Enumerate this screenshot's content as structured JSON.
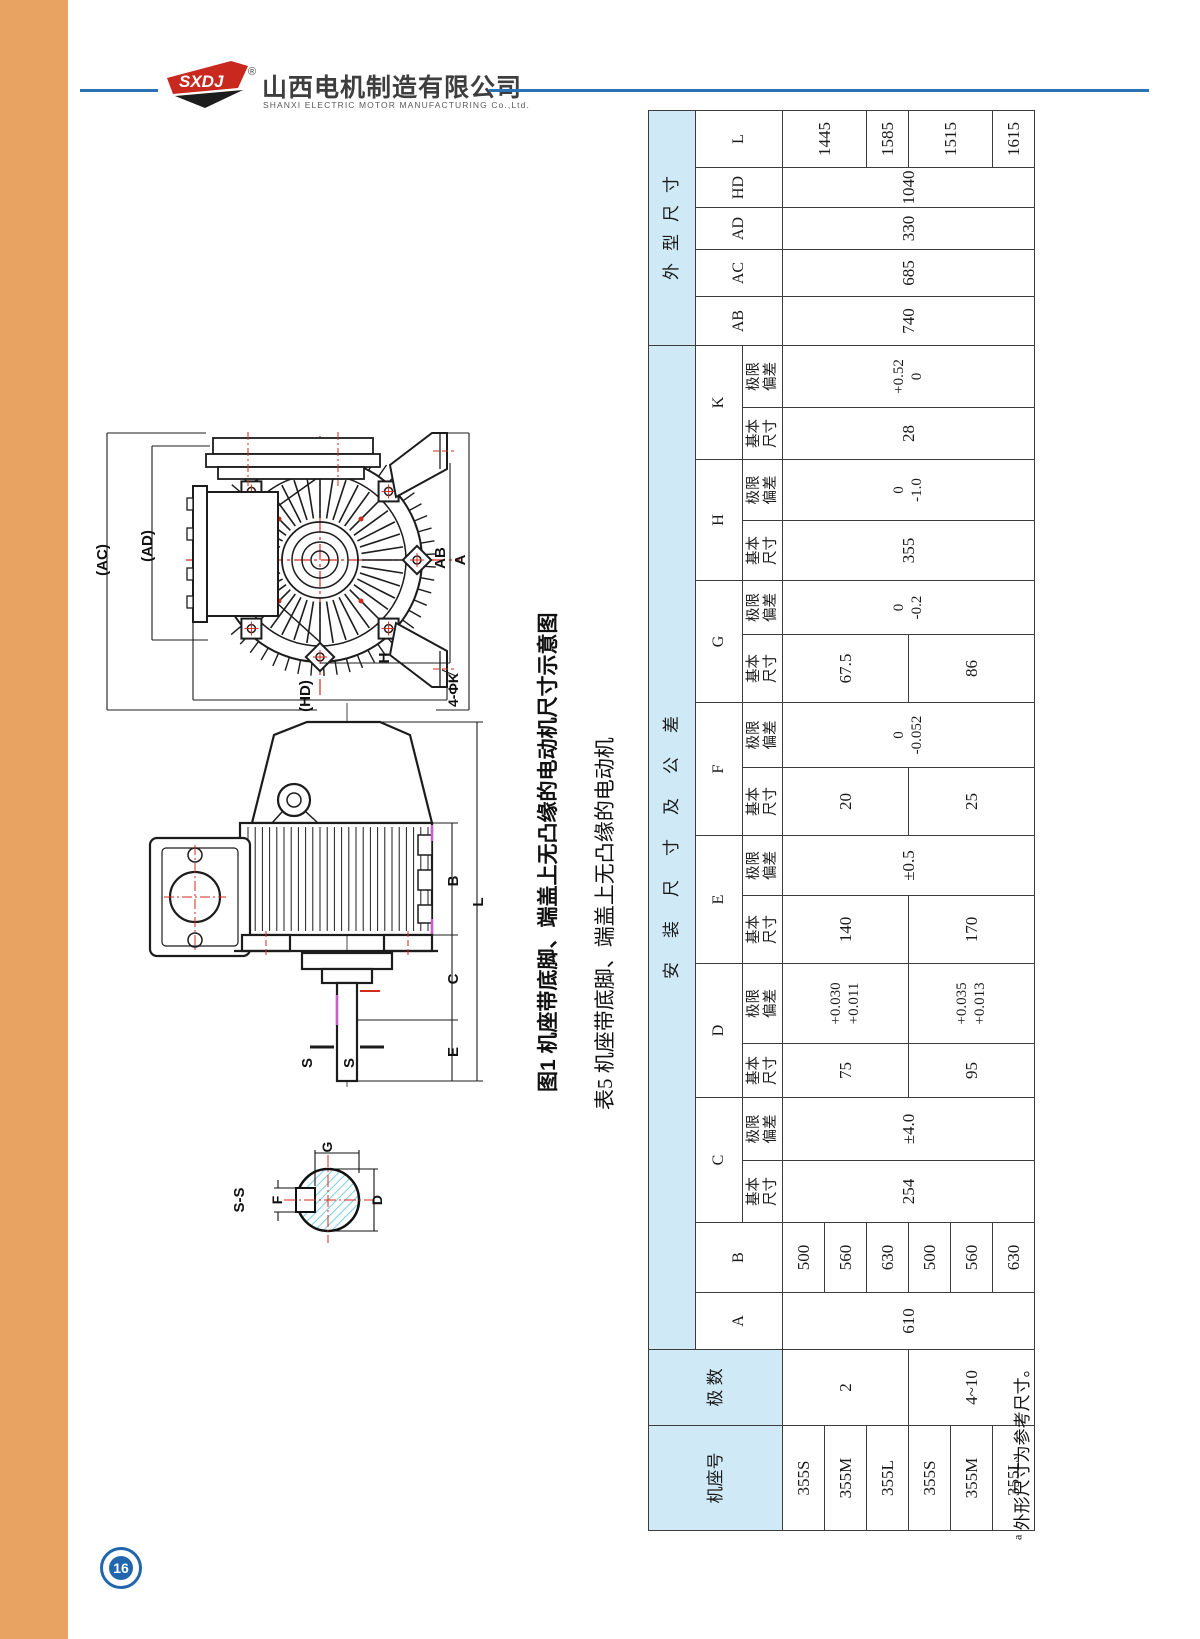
{
  "page": {
    "number": "16"
  },
  "brand": {
    "logo": "SXDJ",
    "registered": "®",
    "company_cn": "山西电机制造有限公司",
    "company_en": "SHANXI ELECTRIC MOTOR MANUFACTURING Co.,Ltd."
  },
  "colors": {
    "orange_bar": "#e8a262",
    "header_fill": "#cfe9f7",
    "rule_blue": "#2a72b5",
    "badge_blue": "#2166ac",
    "centerline_red": "#d42a1e",
    "hatch_cyan": "#7ccfe0"
  },
  "figure": {
    "caption": "图1 机座带底脚、端盖上无凸缘的电动机尺寸示意图",
    "labels": {
      "ac": "(AC)",
      "ad": "(AD)",
      "ab": "AB",
      "a": "A",
      "h": "H",
      "hd": "(HD)",
      "k": "4-ΦK",
      "s_left": "S",
      "s_right": "S",
      "b": "B",
      "c": "C",
      "e": "E",
      "l": "L",
      "section": "S-S",
      "g": "G",
      "f": "F",
      "d": "D"
    }
  },
  "table": {
    "caption": "表5 机座带底脚、端盖上无凸缘的电动机",
    "footnote_mark": "a",
    "footnote": "外形尺寸为参考尺寸。",
    "header_rows": [
      [
        {
          "t": "机座号",
          "rs": 3,
          "h": true,
          "cls": "hd"
        },
        {
          "t": "极 数",
          "rs": 3,
          "h": true,
          "cls": "hd"
        },
        {
          "t": "安装尺寸及公差",
          "cs": 16,
          "h": true,
          "cls": "hd sp7"
        },
        {
          "t": "外型尺寸",
          "cs": 5,
          "h": true,
          "cls": "hd sp4"
        }
      ],
      [
        {
          "t": "A",
          "rs": 2
        },
        {
          "t": "B",
          "rs": 2
        },
        {
          "t": "C",
          "cs": 2
        },
        {
          "t": "D",
          "cs": 2
        },
        {
          "t": "E",
          "cs": 2
        },
        {
          "t": "F",
          "cs": 2
        },
        {
          "t": "G",
          "cs": 2
        },
        {
          "t": "H",
          "cs": 2
        },
        {
          "t": "K",
          "cs": 2
        },
        {
          "t": "AB",
          "rs": 2
        },
        {
          "t": "AC",
          "rs": 2
        },
        {
          "t": "AD",
          "rs": 2
        },
        {
          "t": "HD",
          "rs": 2
        },
        {
          "t": "L",
          "rs": 2
        }
      ],
      [
        {
          "lines": [
            "基本",
            "尺寸"
          ],
          "cls": "sub"
        },
        {
          "lines": [
            "极限",
            "偏差"
          ],
          "cls": "sub"
        },
        {
          "lines": [
            "基本",
            "尺寸"
          ],
          "cls": "sub"
        },
        {
          "lines": [
            "极限",
            "偏差"
          ],
          "cls": "sub"
        },
        {
          "lines": [
            "基本",
            "尺寸"
          ],
          "cls": "sub"
        },
        {
          "lines": [
            "极限",
            "偏差"
          ],
          "cls": "sub"
        },
        {
          "lines": [
            "基本",
            "尺寸"
          ],
          "cls": "sub"
        },
        {
          "lines": [
            "极限",
            "偏差"
          ],
          "cls": "sub"
        },
        {
          "lines": [
            "基本",
            "尺寸"
          ],
          "cls": "sub"
        },
        {
          "lines": [
            "极限",
            "偏差"
          ],
          "cls": "sub"
        },
        {
          "lines": [
            "基本",
            "尺寸"
          ],
          "cls": "sub"
        },
        {
          "lines": [
            "极限",
            "偏差"
          ],
          "cls": "sub"
        },
        {
          "lines": [
            "基本",
            "尺寸"
          ],
          "cls": "sub"
        },
        {
          "lines": [
            "极限",
            "偏差"
          ],
          "cls": "sub"
        }
      ]
    ],
    "data_rows": [
      [
        {
          "t": "355S",
          "cls": "num"
        },
        {
          "t": "2",
          "rs": 3,
          "cls": "num"
        },
        {
          "t": "610",
          "rs": 6,
          "cls": "num"
        },
        {
          "t": "500",
          "cls": "num"
        },
        {
          "t": "254",
          "rs": 6,
          "cls": "num"
        },
        {
          "t": "±4.0",
          "rs": 6,
          "cls": "num"
        },
        {
          "t": "75",
          "rs": 3,
          "cls": "num"
        },
        {
          "lines": [
            "+0.030",
            "+0.011"
          ],
          "rs": 3
        },
        {
          "t": "140",
          "rs": 3,
          "cls": "num"
        },
        {
          "t": "±0.5",
          "rs": 6,
          "cls": "num"
        },
        {
          "t": "20",
          "rs": 3,
          "cls": "num"
        },
        {
          "lines": [
            "0",
            "-0.052"
          ],
          "rs": 6
        },
        {
          "t": "67.5",
          "rs": 3,
          "cls": "num"
        },
        {
          "lines": [
            "0",
            "-0.2"
          ],
          "rs": 6
        },
        {
          "t": "355",
          "rs": 6,
          "cls": "num"
        },
        {
          "lines": [
            "0",
            "-1.0"
          ],
          "rs": 6
        },
        {
          "t": "28",
          "rs": 6,
          "cls": "num"
        },
        {
          "lines": [
            "+0.52",
            "0"
          ],
          "rs": 6
        },
        {
          "t": "740",
          "rs": 6,
          "cls": "num"
        },
        {
          "t": "685",
          "rs": 6,
          "cls": "num"
        },
        {
          "t": "330",
          "rs": 6,
          "cls": "num"
        },
        {
          "t": "1040",
          "rs": 6,
          "cls": "num"
        },
        {
          "t": "1445",
          "rs": 2,
          "cls": "num"
        }
      ],
      [
        {
          "t": "355M",
          "cls": "num"
        },
        {
          "t": "560",
          "cls": "num"
        }
      ],
      [
        {
          "t": "355L",
          "cls": "num"
        },
        {
          "t": "630",
          "cls": "num"
        },
        {
          "t": "1585",
          "cls": "num"
        }
      ],
      [
        {
          "t": "355S",
          "cls": "num"
        },
        {
          "t": "4~10",
          "rs": 3,
          "cls": "num"
        },
        {
          "t": "500",
          "cls": "num"
        },
        {
          "t": "95",
          "rs": 3,
          "cls": "num"
        },
        {
          "lines": [
            "+0.035",
            "+0.013"
          ],
          "rs": 3
        },
        {
          "t": "170",
          "rs": 3,
          "cls": "num"
        },
        {
          "t": "25",
          "rs": 3,
          "cls": "num"
        },
        {
          "t": "86",
          "rs": 3,
          "cls": "num"
        },
        {
          "t": "1515",
          "rs": 2,
          "cls": "num"
        }
      ],
      [
        {
          "t": "355M",
          "cls": "num"
        },
        {
          "t": "560",
          "cls": "num"
        }
      ],
      [
        {
          "t": "355L",
          "cls": "num"
        },
        {
          "t": "630",
          "cls": "num"
        },
        {
          "t": "1615",
          "cls": "num"
        }
      ]
    ]
  }
}
